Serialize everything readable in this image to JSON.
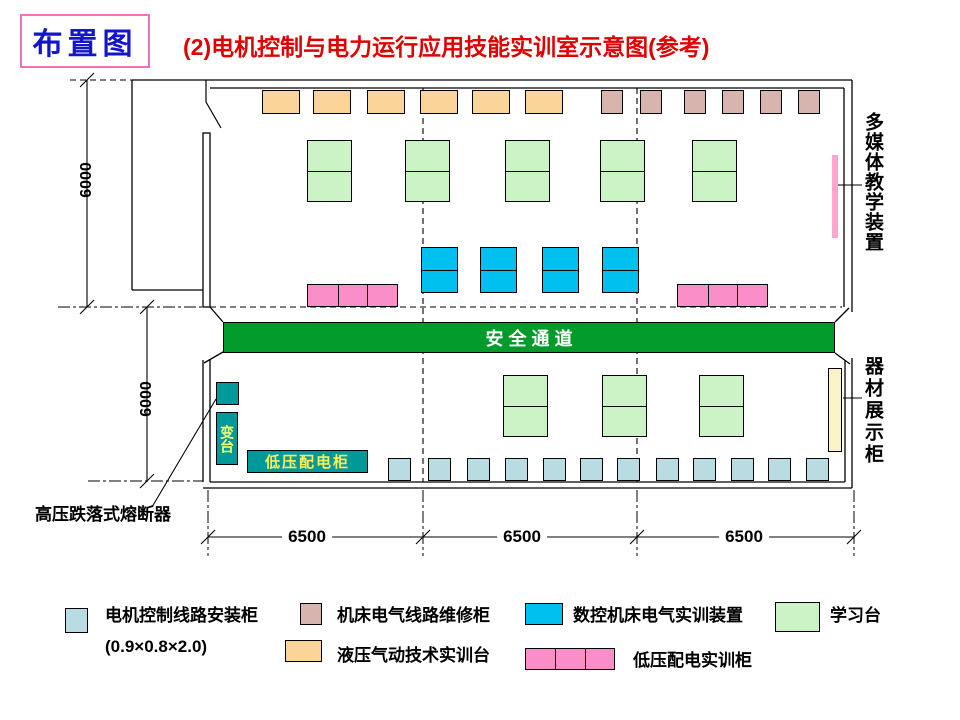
{
  "corner_label": "布置图",
  "title": "(2)电机控制与电力运行应用技能实训室示意图(参考)",
  "corridor_label": "安全通道",
  "right_labels": {
    "media": "多媒体教学装置",
    "display": "器材展示柜"
  },
  "fuse_label": "高压跌落式熔断器",
  "transformer_label": "变台",
  "lv_panel_label": "低压配电柜",
  "dims": {
    "v_top": "6000",
    "v_bottom": "6000",
    "bays": [
      "6500",
      "6500",
      "6500"
    ]
  },
  "legend": {
    "install": {
      "label": "电机控制线路安装柜",
      "sub": "(0.9×0.8×2.0)"
    },
    "repair": {
      "label": "机床电气线路维修柜"
    },
    "hydraulic": {
      "label": "液压气动技术实训台"
    },
    "cnc": {
      "label": "数控机床电气实训装置"
    },
    "table": {
      "label": "学习台"
    },
    "lv": {
      "label": "低压配电实训柜"
    }
  },
  "colors": {
    "install_cabinet": "#b9dce2",
    "repair_cabinet": "#d7b5ae",
    "hydraulic_bench": "#fbd49a",
    "cnc_device": "#00c0f0",
    "learning_table": "#ccf3c6",
    "lv_training": "#f98ec9",
    "corridor": "#009b2a",
    "teal": "#00999a",
    "display_cabinet": "#fbf3c8",
    "media_bar": "#f6a8ce",
    "title_red": "#e00000",
    "corner_blue": "#1414cc",
    "corner_border": "#f272b6"
  },
  "plan": {
    "groups": [
      {
        "name": "hydraulic-bench",
        "color": "hydraulic_bench",
        "cells": 1,
        "items": [
          {
            "x": 262,
            "y": 90,
            "w": 38,
            "h": 24
          },
          {
            "x": 313,
            "y": 90,
            "w": 38,
            "h": 24
          },
          {
            "x": 367,
            "y": 90,
            "w": 38,
            "h": 24
          },
          {
            "x": 420,
            "y": 90,
            "w": 38,
            "h": 24
          },
          {
            "x": 472,
            "y": 90,
            "w": 38,
            "h": 24
          },
          {
            "x": 525,
            "y": 90,
            "w": 38,
            "h": 24
          }
        ]
      },
      {
        "name": "repair-cabinet",
        "color": "repair_cabinet",
        "cells": 1,
        "items": [
          {
            "x": 601,
            "y": 90,
            "w": 22,
            "h": 24
          },
          {
            "x": 640,
            "y": 90,
            "w": 22,
            "h": 24
          },
          {
            "x": 684,
            "y": 90,
            "w": 22,
            "h": 24
          },
          {
            "x": 722,
            "y": 90,
            "w": 22,
            "h": 24
          },
          {
            "x": 760,
            "y": 90,
            "w": 22,
            "h": 24
          },
          {
            "x": 798,
            "y": 90,
            "w": 22,
            "h": 24
          }
        ]
      },
      {
        "name": "learning-table",
        "color": "learning_table",
        "cells": "v2",
        "items": [
          {
            "x": 307,
            "y": 140,
            "w": 45,
            "h": 62
          },
          {
            "x": 405,
            "y": 140,
            "w": 45,
            "h": 62
          },
          {
            "x": 505,
            "y": 140,
            "w": 45,
            "h": 62
          },
          {
            "x": 600,
            "y": 140,
            "w": 45,
            "h": 62
          },
          {
            "x": 692,
            "y": 140,
            "w": 45,
            "h": 62
          }
        ]
      },
      {
        "name": "cnc-training-device",
        "color": "cnc_device",
        "cells": "v2",
        "items": [
          {
            "x": 421,
            "y": 247,
            "w": 37,
            "h": 46
          },
          {
            "x": 480,
            "y": 247,
            "w": 37,
            "h": 46
          },
          {
            "x": 542,
            "y": 247,
            "w": 37,
            "h": 46
          },
          {
            "x": 602,
            "y": 247,
            "w": 37,
            "h": 46
          }
        ]
      },
      {
        "name": "lv-training-cabinet",
        "color": "lv_training",
        "cells": "h3",
        "items": [
          {
            "x": 307,
            "y": 284,
            "w": 91,
            "h": 23
          },
          {
            "x": 677,
            "y": 284,
            "w": 91,
            "h": 23
          }
        ]
      },
      {
        "name": "learning-table-bottom",
        "color": "learning_table",
        "cells": "v2",
        "items": [
          {
            "x": 503,
            "y": 375,
            "w": 45,
            "h": 62
          },
          {
            "x": 602,
            "y": 375,
            "w": 45,
            "h": 62
          },
          {
            "x": 699,
            "y": 375,
            "w": 45,
            "h": 62
          }
        ]
      },
      {
        "name": "motor-install-cabinet",
        "color": "install_cabinet",
        "cells": 1,
        "items": [
          {
            "x": 388,
            "y": 458,
            "w": 23,
            "h": 23
          },
          {
            "x": 428,
            "y": 458,
            "w": 23,
            "h": 23
          },
          {
            "x": 467,
            "y": 458,
            "w": 23,
            "h": 23
          },
          {
            "x": 505,
            "y": 458,
            "w": 23,
            "h": 23
          },
          {
            "x": 543,
            "y": 458,
            "w": 23,
            "h": 23
          },
          {
            "x": 580,
            "y": 458,
            "w": 23,
            "h": 23
          },
          {
            "x": 617,
            "y": 458,
            "w": 23,
            "h": 23
          },
          {
            "x": 656,
            "y": 458,
            "w": 23,
            "h": 23
          },
          {
            "x": 693,
            "y": 458,
            "w": 23,
            "h": 23
          },
          {
            "x": 731,
            "y": 458,
            "w": 23,
            "h": 23
          },
          {
            "x": 768,
            "y": 458,
            "w": 23,
            "h": 23
          },
          {
            "x": 806,
            "y": 458,
            "w": 23,
            "h": 23
          }
        ]
      },
      {
        "name": "hv-fuse-box",
        "color": "teal",
        "cells": 1,
        "items": [
          {
            "x": 216,
            "y": 382,
            "w": 23,
            "h": 23
          }
        ]
      },
      {
        "name": "multimedia-bar",
        "color": "media_bar",
        "cells": 1,
        "noborder": true,
        "items": [
          {
            "x": 832,
            "y": 155,
            "w": 6,
            "h": 83
          }
        ]
      },
      {
        "name": "equipment-display-cabinet",
        "color": "display_cabinet",
        "cells": 1,
        "items": [
          {
            "x": 828,
            "y": 368,
            "w": 14,
            "h": 84
          }
        ]
      },
      {
        "name": "legend-swatch-install",
        "color": "install_cabinet",
        "cells": 1,
        "items": [
          {
            "x": 65,
            "y": 608,
            "w": 23,
            "h": 25
          }
        ]
      },
      {
        "name": "legend-swatch-repair",
        "color": "repair_cabinet",
        "cells": 1,
        "items": [
          {
            "x": 300,
            "y": 603,
            "w": 22,
            "h": 22
          }
        ]
      },
      {
        "name": "legend-swatch-hydraulic",
        "color": "hydraulic_bench",
        "cells": 1,
        "items": [
          {
            "x": 285,
            "y": 640,
            "w": 37,
            "h": 22
          }
        ]
      },
      {
        "name": "legend-swatch-cnc",
        "color": "cnc_device",
        "cells": 1,
        "items": [
          {
            "x": 525,
            "y": 603,
            "w": 38,
            "h": 22
          }
        ]
      },
      {
        "name": "legend-swatch-table",
        "color": "learning_table",
        "cells": 1,
        "items": [
          {
            "x": 775,
            "y": 602,
            "w": 45,
            "h": 30
          }
        ]
      },
      {
        "name": "legend-swatch-lv",
        "color": "lv_training",
        "cells": "h3",
        "items": [
          {
            "x": 525,
            "y": 648,
            "w": 90,
            "h": 22
          }
        ]
      }
    ]
  }
}
